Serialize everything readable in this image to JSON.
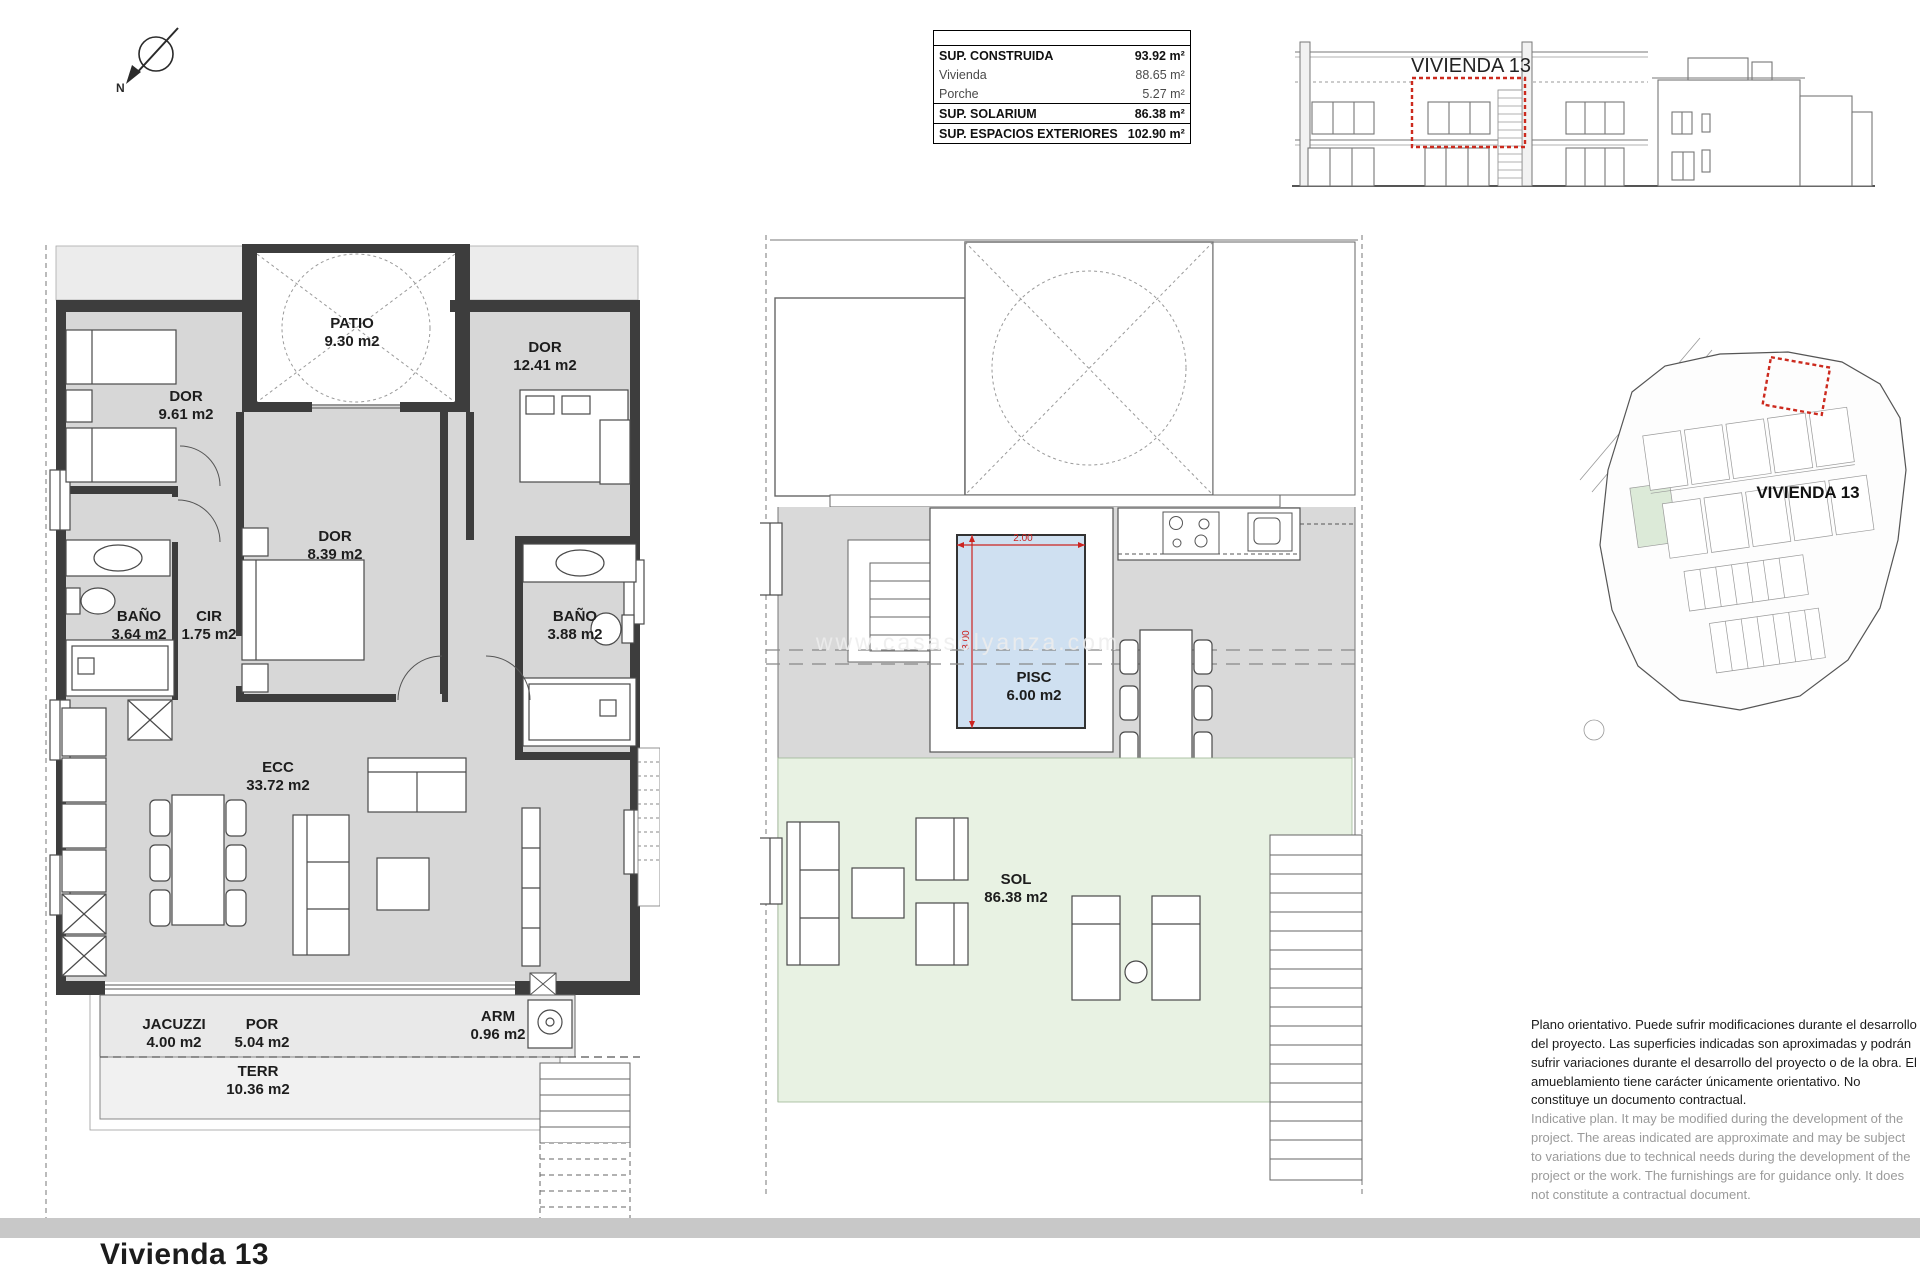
{
  "page": {
    "title": "Vivienda 13",
    "watermark": "www.casasolyanza.com"
  },
  "compass": {
    "label": "N"
  },
  "areas_table": {
    "rows": [
      {
        "label": "SUP. CONSTRUIDA",
        "value": "93.92 m²"
      },
      {
        "label": "Vivienda",
        "value": "88.65 m²"
      },
      {
        "label": "Porche",
        "value": "5.27 m²"
      },
      {
        "label": "SUP. SOLARIUM",
        "value": "86.38 m²"
      },
      {
        "label": "SUP. ESPACIOS EXTERIORES",
        "value": "102.90 m²"
      }
    ]
  },
  "elevation": {
    "unit_label": "VIVIENDA 13"
  },
  "site_plan": {
    "unit_label": "VIVIENDA 13"
  },
  "floor_plan": {
    "rooms": [
      {
        "name": "DOR",
        "area": "9.61 m2"
      },
      {
        "name": "PATIO",
        "area": "9.30 m2"
      },
      {
        "name": "DOR",
        "area": "12.41 m2"
      },
      {
        "name": "DOR",
        "area": "8.39 m2"
      },
      {
        "name": "BAÑO",
        "area": "3.64 m2"
      },
      {
        "name": "CIR",
        "area": "1.75 m2"
      },
      {
        "name": "BAÑO",
        "area": "3.88 m2"
      },
      {
        "name": "ECC",
        "area": "33.72 m2"
      },
      {
        "name": "JACUZZI",
        "area": "4.00 m2"
      },
      {
        "name": "POR",
        "area": "5.04 m2"
      },
      {
        "name": "TERR",
        "area": "10.36 m2"
      },
      {
        "name": "ARM",
        "area": "0.96 m2"
      }
    ]
  },
  "solarium_plan": {
    "rooms": [
      {
        "name": "PISC",
        "area": "6.00 m2"
      },
      {
        "name": "SOL",
        "area": "86.38 m2"
      }
    ],
    "pool_dimensions": {
      "width": "2.00",
      "depth": "3.00"
    }
  },
  "disclaimer": {
    "spanish": "Plano orientativo. Puede sufrir modificaciones durante el desarrollo del proyecto. Las superficies indicadas son aproximadas y podrán sufrir variaciones durante el desarrollo del proyecto o de la obra. El amueblamiento tiene carácter únicamente orientativo. No constituye un documento contractual.",
    "english": "Indicative plan. It may be modified during the development of the project. The areas indicated are approximate and may be subject to variations due to technical needs during the development of the project or the work. The furnishings are for guidance only. It does not constitute a contractual document."
  }
}
